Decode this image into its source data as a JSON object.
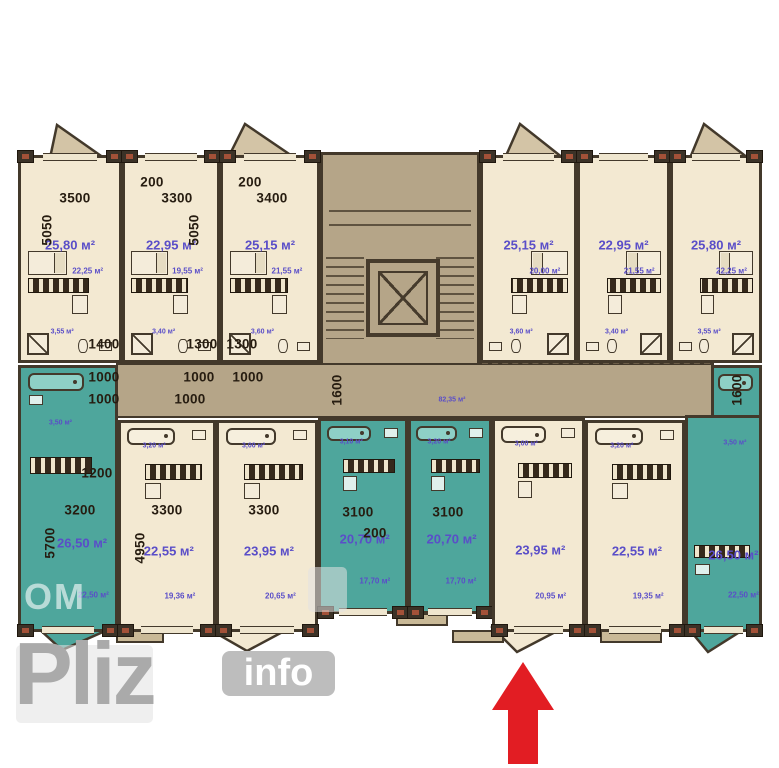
{
  "watermark": {
    "big": "Pliz",
    "badge": "info",
    "corner": "OM"
  },
  "corridor": {
    "area_label": "82,35 м²"
  },
  "colors": {
    "cream": "#f3e9d2",
    "teal": "#4ea69c",
    "teal_light": "#8ed0c6",
    "tan": "#b5a588",
    "wall": "#43392b",
    "dim": "#261c10",
    "area": "#5a4ec8",
    "red": "#e21d23",
    "wm": "#ababab"
  },
  "top_units": [
    {
      "id": "tl-1",
      "x": 18,
      "y": 155,
      "w": 104,
      "h": 208,
      "color": "cream",
      "area": "25,80 м²",
      "sub": "22,25 м²",
      "bath": "3,55 м²"
    },
    {
      "id": "tl-2",
      "x": 122,
      "y": 155,
      "w": 98,
      "h": 208,
      "color": "cream",
      "area": "22,95 м²",
      "sub": "19,55 м²",
      "bath": "3,40 м²"
    },
    {
      "id": "tl-3",
      "x": 220,
      "y": 155,
      "w": 100,
      "h": 208,
      "color": "cream",
      "area": "25,15 м²",
      "sub": "21,55 м²",
      "bath": "3,60 м²"
    },
    {
      "id": "tr-1",
      "x": 480,
      "y": 155,
      "w": 97,
      "h": 208,
      "color": "cream",
      "mirror": true,
      "area": "25,15 м²",
      "sub": "20,00 м²",
      "bath": "3,60 м²"
    },
    {
      "id": "tr-2",
      "x": 577,
      "y": 155,
      "w": 93,
      "h": 208,
      "color": "cream",
      "mirror": true,
      "area": "22,95 м²",
      "sub": "21,55 м²",
      "bath": "3,40 м²"
    },
    {
      "id": "tr-3",
      "x": 670,
      "y": 155,
      "w": 92,
      "h": 208,
      "color": "cream",
      "mirror": true,
      "area": "25,80 м²",
      "sub": "22,25 м²",
      "bath": "3,55 м²"
    }
  ],
  "bottom_units": [
    {
      "id": "b-1",
      "x": 18,
      "y": 365,
      "w": 100,
      "h": 267,
      "color": "teal",
      "fv": "tall",
      "area": "26,50 м²",
      "sub": "22,50 м²",
      "bath": "3,50 м²",
      "lbl": {
        "area": [
          65,
          67
        ],
        "sub": [
          77,
          87
        ],
        "bath": [
          42,
          21
        ]
      }
    },
    {
      "id": "b-2",
      "x": 118,
      "y": 420,
      "w": 98,
      "h": 212,
      "color": "cream",
      "area": "22,55 м²",
      "sub": "19,36 м²",
      "bath": "3,20 м²"
    },
    {
      "id": "b-3",
      "x": 216,
      "y": 420,
      "w": 102,
      "h": 212,
      "color": "cream",
      "area": "23,95 м²",
      "sub": "20,65 м²",
      "bath": "3,00 м²"
    },
    {
      "id": "b-4",
      "x": 318,
      "y": 418,
      "w": 90,
      "h": 196,
      "color": "teal",
      "area": "20,70 м²",
      "sub": "17,70 м²",
      "bath": "3,10 м²"
    },
    {
      "id": "b-5",
      "x": 408,
      "y": 418,
      "w": 84,
      "h": 196,
      "color": "teal",
      "area": "20,70 м²",
      "sub": "17,70 м²",
      "bath": "3,20 м²"
    },
    {
      "id": "b-6",
      "x": 492,
      "y": 418,
      "w": 93,
      "h": 214,
      "color": "cream",
      "area": "23,95 м²",
      "sub": "20,95 м²",
      "bath": "3,00 м²"
    },
    {
      "id": "b-7",
      "x": 585,
      "y": 420,
      "w": 100,
      "h": 212,
      "color": "cream",
      "area": "22,55 м²",
      "sub": "19,35 м²",
      "bath": "3,20 м²"
    },
    {
      "id": "b-8",
      "x": 685,
      "y": 415,
      "w": 77,
      "h": 217,
      "color": "teal",
      "fv": "b8",
      "area": "26,50 м²",
      "sub": "22,50 м²",
      "bath": "3,50 м²",
      "lbl": {
        "area": [
          64,
          65
        ],
        "sub": [
          78,
          84
        ],
        "bath": [
          66,
          12
        ]
      },
      "ext": {
        "x": 711,
        "y": 365,
        "w": 51,
        "h": 53
      }
    }
  ],
  "dimension_labels": [
    {
      "t": "3500",
      "x": 75,
      "y": 198
    },
    {
      "t": "200",
      "x": 152,
      "y": 182
    },
    {
      "t": "3300",
      "x": 177,
      "y": 198
    },
    {
      "t": "200",
      "x": 250,
      "y": 182
    },
    {
      "t": "3400",
      "x": 272,
      "y": 198
    },
    {
      "t": "5050",
      "x": 47,
      "y": 230,
      "v": 1
    },
    {
      "t": "5050",
      "x": 194,
      "y": 230,
      "v": 1
    },
    {
      "t": "1400",
      "x": 104,
      "y": 344
    },
    {
      "t": "1300",
      "x": 202,
      "y": 344
    },
    {
      "t": "1300",
      "x": 242,
      "y": 344
    },
    {
      "t": "1000",
      "x": 104,
      "y": 377
    },
    {
      "t": "1000",
      "x": 104,
      "y": 399
    },
    {
      "t": "1000",
      "x": 199,
      "y": 377
    },
    {
      "t": "1000",
      "x": 248,
      "y": 377
    },
    {
      "t": "1000",
      "x": 190,
      "y": 399
    },
    {
      "t": "1600",
      "x": 337,
      "y": 390,
      "v": 1
    },
    {
      "t": "1600",
      "x": 737,
      "y": 390,
      "v": 1
    },
    {
      "t": "1200",
      "x": 97,
      "y": 473
    },
    {
      "t": "3200",
      "x": 80,
      "y": 510
    },
    {
      "t": "5700",
      "x": 50,
      "y": 543,
      "v": 1
    },
    {
      "t": "3300",
      "x": 167,
      "y": 510
    },
    {
      "t": "4950",
      "x": 140,
      "y": 548,
      "v": 1
    },
    {
      "t": "3300",
      "x": 264,
      "y": 510
    },
    {
      "t": "3100",
      "x": 358,
      "y": 512
    },
    {
      "t": "3100",
      "x": 448,
      "y": 512
    },
    {
      "t": "200",
      "x": 375,
      "y": 533
    }
  ]
}
